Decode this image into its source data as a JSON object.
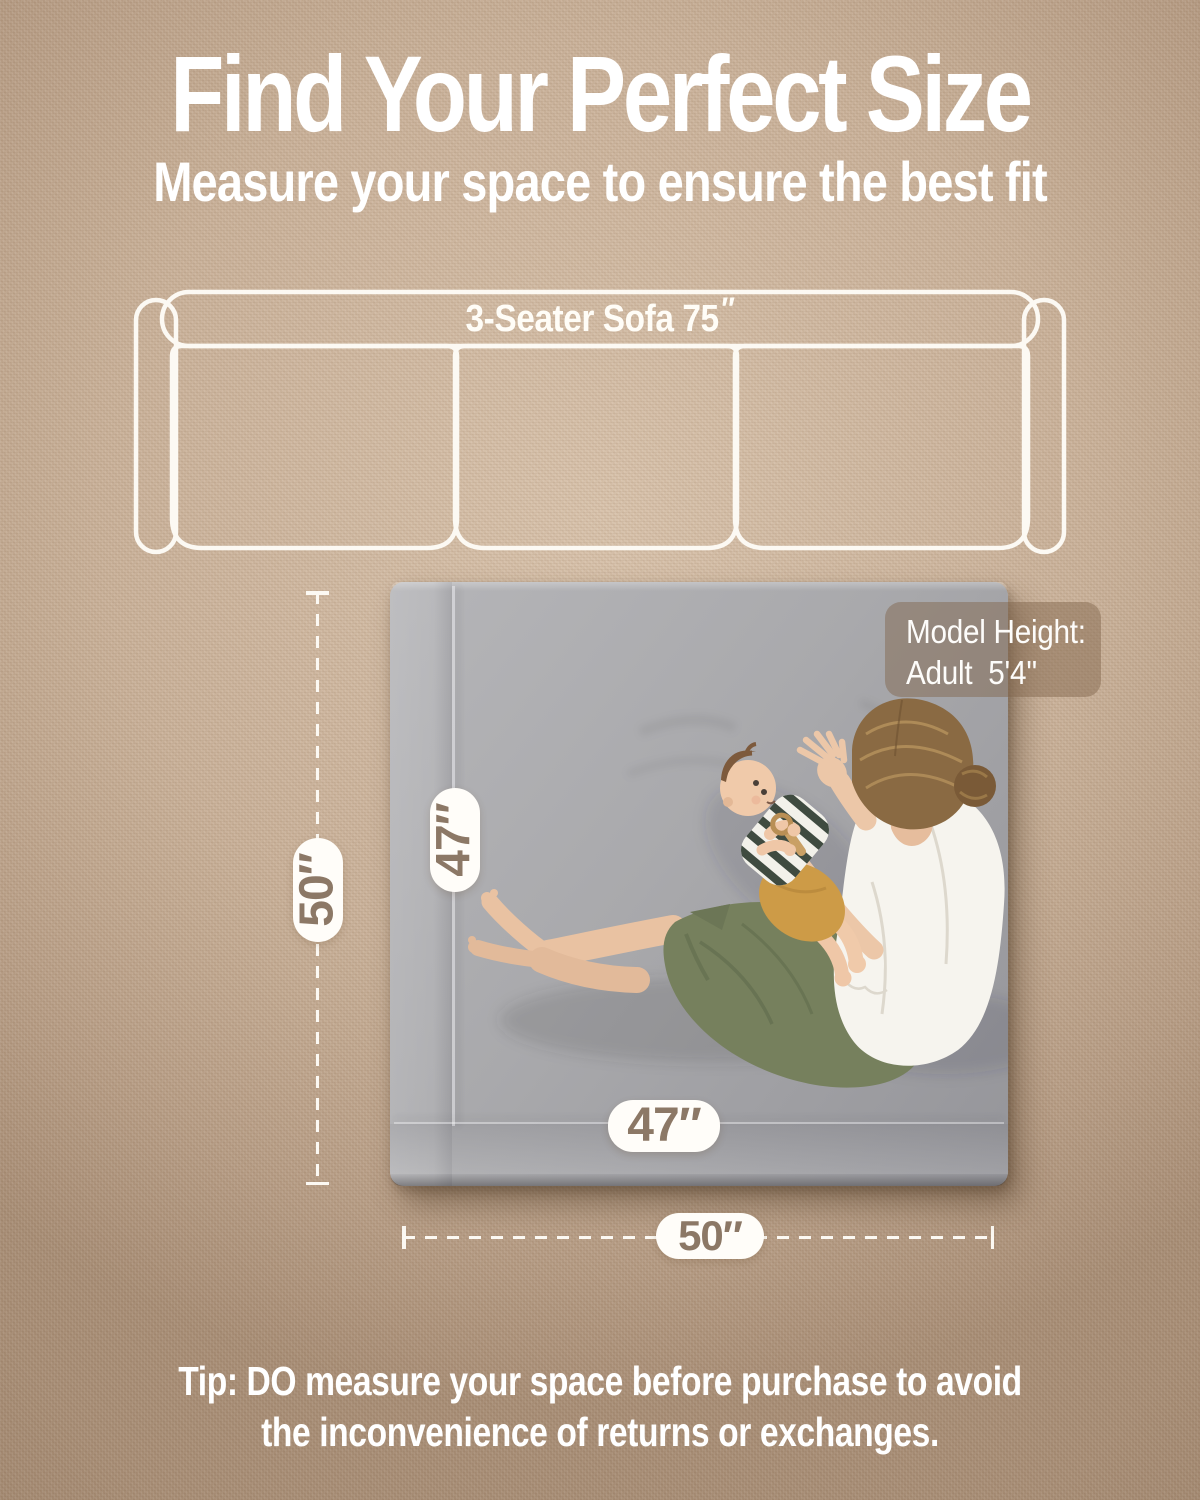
{
  "header": {
    "title": "Find Your Perfect Size",
    "subtitle": "Measure your space to ensure the best fit"
  },
  "sofa": {
    "label": "3-Seater Sofa 75",
    "inch_mark": "″"
  },
  "dimensions": {
    "space_height": "50″",
    "space_width": "50″",
    "mat_height": "47″",
    "mat_width": "47″"
  },
  "model_badge": {
    "line1": "Model Height:",
    "line2": "Adult  5'4''"
  },
  "tip": {
    "line1": "Tip: DO measure your space before purchase to avoid",
    "line2": "the inconvenience of returns or exchanges."
  },
  "colors": {
    "background_tan": "#c9b199",
    "outline_white": "#fcf9f3",
    "mat_gray": "#a9a9ac",
    "pill_bg": "#fffdf9",
    "pill_text_brown": "#8c7866",
    "badge_bg": "rgba(130,102,78,0.48)",
    "pants_olive": "#76805d",
    "baby_shorts_mustard": "#cd9b47",
    "shirt_white": "#f6f4ee",
    "skin": "#e9c2a2",
    "hair_brown": "#8a6a43"
  }
}
